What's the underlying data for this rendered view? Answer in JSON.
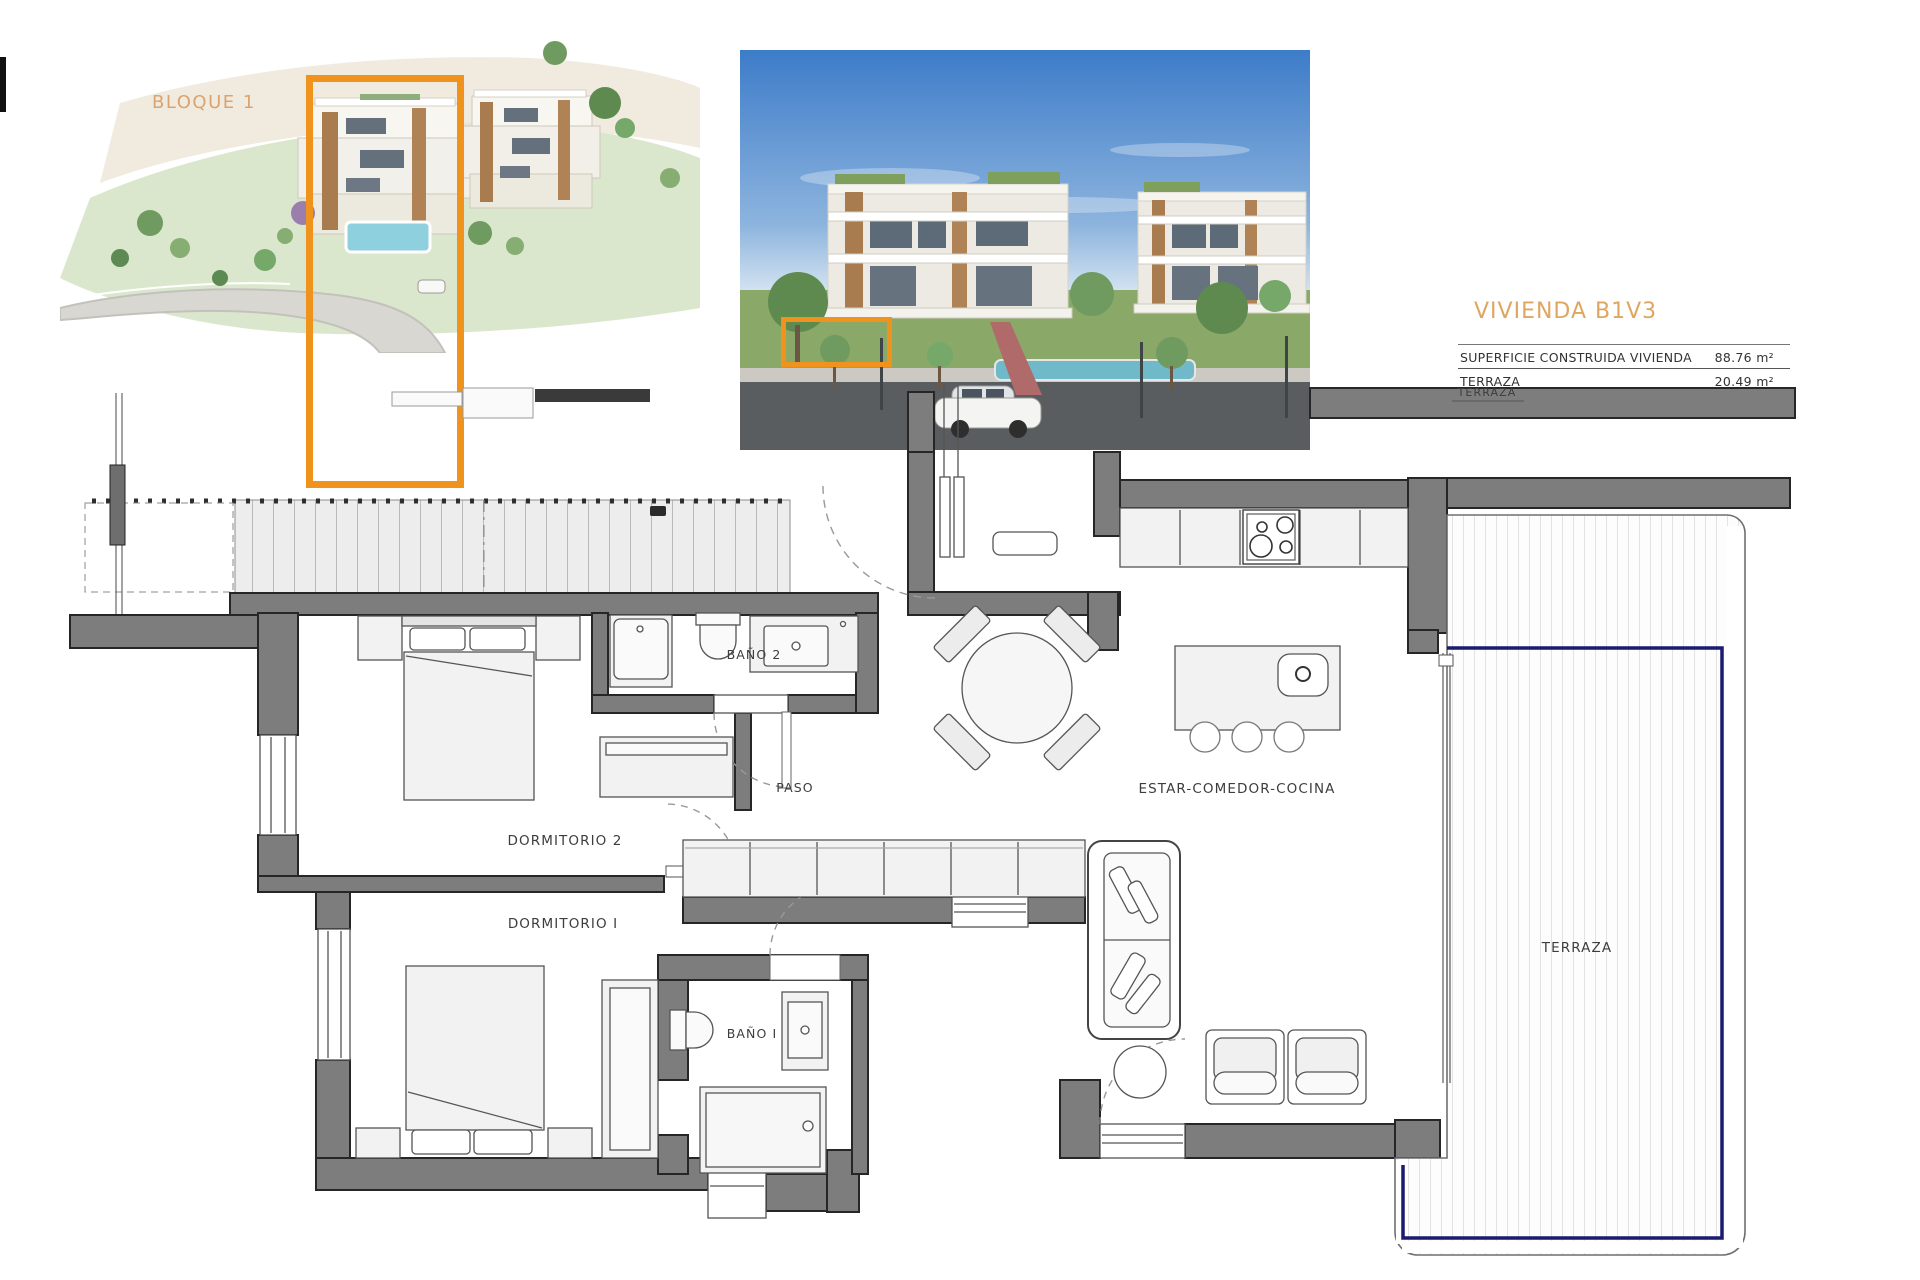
{
  "page": {
    "width": 1920,
    "height": 1280,
    "background": "#ffffff"
  },
  "header": {
    "block_label": "BLOQUE 1",
    "title": "VIVIENDA B1V3",
    "surface_table": {
      "rows": [
        {
          "label": "SUPERFICIE CONSTRUIDA VIVIENDA",
          "value": "88.76 m²"
        },
        {
          "label": "TERRAZA",
          "value": "20.49 m²"
        }
      ]
    }
  },
  "floorplan": {
    "labels": {
      "dormitorio2": "DORMITORIO 2",
      "dormitorio1": "DORMITORIO I",
      "bano2": "BAÑO 2",
      "bano1": "BAÑO I",
      "paso": "PASO",
      "estar_comedor_cocina": "ESTAR-COMEDOR-COCINA",
      "terraza": "TERRAZA",
      "terraza_upper": "TERRAZA"
    },
    "colors": {
      "wall": "#7d7d7d",
      "wall_outline": "#262626",
      "highlight_orange": "#F0931D",
      "balustrade_navy": "#1b1b70",
      "label_text": "#3d3d3d",
      "accent_tan": "#DFA660"
    }
  }
}
